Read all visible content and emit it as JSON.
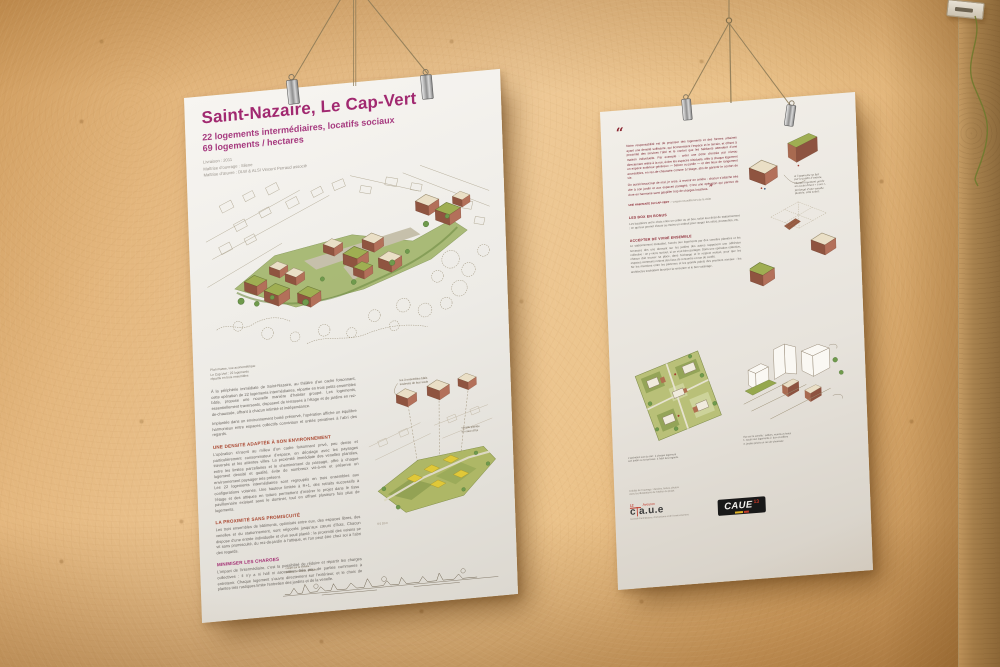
{
  "scene": {
    "wall_color": "#e9c491",
    "accent_magenta": "#a12970",
    "accent_red": "#a8432c",
    "quote_red": "#7d2430"
  },
  "left_poster": {
    "title": "Saint-Nazaire, Le Cap-Vert",
    "subtitle_lines": [
      "22 logements intermédiaires, locatifs sociaux",
      "69 logements / hectares"
    ],
    "meta_lines": [
      "Livraison : 2011",
      "Maîtrise d’ouvrage : Silene",
      "Maîtrise d’œuvre : DLW & ALSI Vincent Perraud associé"
    ],
    "main_caption": "Plan masse, vue axonométrique\nLe Cap-Vert : 22 logements\nrépartis en trois ensembles",
    "intro_paragraphs": [
      "À la périphérie immédiate de Saint-Nazaire, au théâtre d’un cadre foisonnant, cette opération de 22 logements intermédiaires, répartie en trois petits ensembles bâtis, propose une nouvelle manière d’habiter groupé. Les logements, essentiellement traversants, disposent de terrasses à l’étage et de jardins en rez-de-chaussée, offrant à chacun intimité et indépendance.",
      "Implantée dans un environnement boisé préservé, l’opération affiche un équilibre harmonieux entre espaces collectifs conviviaux et unités privatives à l’abri des regards."
    ],
    "sections": [
      {
        "heading": "UNE DENSITÉ ADAPTÉE À SON ENVIRONNEMENT",
        "body": "L’opération s’inscrit au milieu d’un cadre foisonnant privé, peu dense et particulièrement consommateur d’espace, en décalage avec les paysages traversés et les attentes villes. La proximité immédiate des venelles plantées, entre les limites parcellaires et le cheminement du passage, offre à chaque logement densité et qualité, évite de nombreux vis-à-vis et préserve un environnement paysager très présent.\nLes 22 logements intermédiaires sont regroupés en trois ensembles aux configurations voisines. Une hauteur limitée à R+1, des retraits successifs à l’étage et des attiques en toiture permettent d’insérer le projet dans le tissu pavillonnaire existant sans le dominer, tout en offrant plusieurs fois plus de logements."
      },
      {
        "heading": "LA PROXIMITÉ SANS PROMISCUITÉ",
        "body": "Les trois ensembles de bâtiments, optimisés entre eux, des espaces libres, des venelles et du stationnement, sont négociés jusqu’aux cœurs d’îlots. Chacun dispose d’une entrée individuelle et d’un seuil planté : la proximité des voisins se vit sans promiscuité, du rez-de-jardin à l’attique, et l’on peut être chez soi à l’abri des regards."
      },
      {
        "heading": "MINIMISER LES CHARGES",
        "body": "L’impact de l’intermédiaire, c’est la possibilité de réduire et répartir les charges collectives : il n’y a ni hall ni ascenseur, très peu de parties communes à entretenir. Chaque logement s’ouvre directement sur l’extérieur, et le choix de plantes très rustiques limite l’entretien des jardins et de la venelle."
      }
    ],
    "axon_annotations": {
      "a1": "les 3 ensembles bâtis",
      "a2": "soulevés de leur socle",
      "b1": "venelle plantée",
      "b2": "en cœur d’îlot",
      "scale": "0      5      10 m"
    },
    "elevation_caption": "coupe sur la venelle :\njardins, terrasses, attiques"
  },
  "right_poster": {
    "quote_open": "“",
    "quote_close": "”",
    "quote_paragraphs": [
      "Notre responsabilité est de proposer des logements et des formes urbaines ayant une densité suffisante, qui économisent l’espace et le terrain, et offrent à proximité des services l’abri et le confort que les habitants attendent d’une maison individuelle. Par exemple : créer une porte d’entrée par niveau directement reliée à la rue, éviter les espaces résiduels, offrir à chaque logement un espace extérieur généreux — balcon ou jardin — et des lieux de rangement accessibles, en rez-de-chaussée comme à l’étage, afin de garantir le confort de vie.",
      "On aurait beaucoup de mal, je crois, à revenir en arrière : chacun s’attache très vite à son jardin et aux espaces partagés. C’est une opération qui permet de vivre en harmonie sans gaspiller trop de charges locatives."
    ],
    "quote_attribution_name": "UNE HABITANTE DU CAP-VERT",
    "quote_attribution_rest": " — propos recueillis lors de la visite",
    "sections": [
      {
        "heading": "LES BOX EN BONUS",
        "body": "Les locataires ont le choix entre un cellier ou un box, selon leur désir de stationnement ; ce qui leur permet d’avoir au moins un endroit pour ranger les vélos, poussettes, etc."
      },
      {
        "heading": "ACCEPTER DE VIVRE ENSEMBLE",
        "body": "Le stationnement mutualisé, l’accès aux logements par des venelles plantées et les terrasses des uns donnant sur les jardins des autres supposent une adhésion collective : on y vient, surtout, si on veut bien partager. Dans une opération collective, chacun doit trouver sa place, dans l’échange et le respect mutuel, pour que les espaces communs restent des lieux de rencontre et non de conflit.\nNe les mentions entre les parterres et les grands palets des premiers niveaux : les architectes souhaitent favoriser la rencontre et le bon voisinage."
      }
    ],
    "annotation": "si l’approche se fait\npar le jardin d’entrée,\nchaque logement garde\nun accès direct « à soi »,\nprolongé d’une venelle\nplantée, côté soleil.",
    "bottom_captions": {
      "plan": "L’opération vue du ciel : à chaque logement\nson jardin ou sa terrasse, à l’abri des regards.",
      "axon": "Vue sur la venelle : celliers, murets et haies\n1. accès aux logements   2. box et celliers\n3. jardins privés en rez-de-chaussée"
    },
    "credit_lines": [
      "Crédits de l’ouvrage : dessins, textes, photos",
      "Avec les illustrations de l’atelier du projet"
    ],
    "logo_caue12": {
      "number": "12",
      "region": "Aveyron",
      "acronym_c": "c",
      "divider": "|",
      "acronym_rest": "a.u.e",
      "tagline": "Conseil d’architecture, d’urbanisme et de l’environnement"
    },
    "logo_caue13": {
      "acronym": "CAUE",
      "number": "13"
    }
  }
}
